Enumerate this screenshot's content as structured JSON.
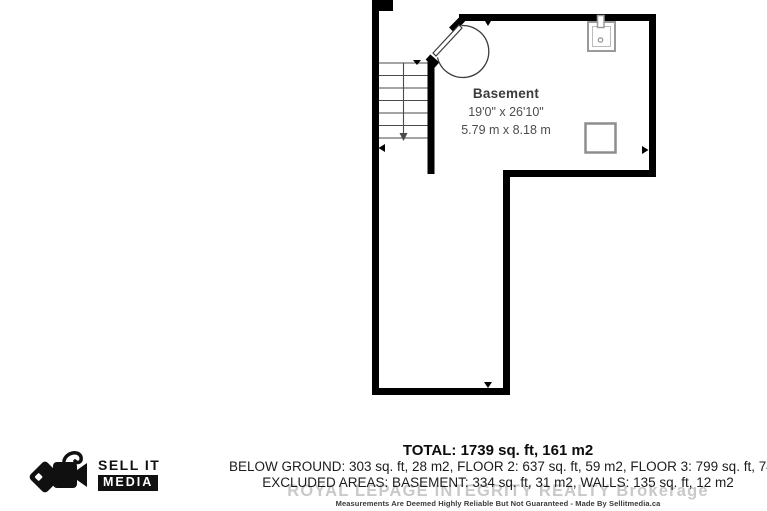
{
  "floor_plan": {
    "room_label": "Basement",
    "dimensions_imperial": "19'0\" x 26'10\"",
    "dimensions_metric": "5.79 m x 8.18 m",
    "icons": {
      "sink": "sink-icon",
      "utility_box": "utility-square",
      "stairs": "stairs-down-arrow",
      "door": "door-swing-arc"
    },
    "wall_color": "#000000"
  },
  "summary": {
    "total": "TOTAL: 1739 sq. ft, 161 m2",
    "areas_line": "BELOW GROUND: 303 sq. ft, 28 m2, FLOOR 2: 637 sq. ft, 59 m2, FLOOR 3: 799 sq. ft, 74 m2",
    "excluded_line": "EXCLUDED AREAS: BASEMENT: 334 sq. ft, 31 m2, WALLS: 135 sq. ft, 12 m2",
    "watermark": "ROYAL LEPAGE INTEGRITY REALTY Brokerage",
    "watermark_color": "#c9c9c9",
    "disclaimer": "Measurements Are Deemed Highly Reliable But Not Guaranteed - Made By Sellitmedia.ca"
  },
  "logo": {
    "line1": "SELL IT",
    "line2": "MEDIA",
    "color": "#101010"
  }
}
